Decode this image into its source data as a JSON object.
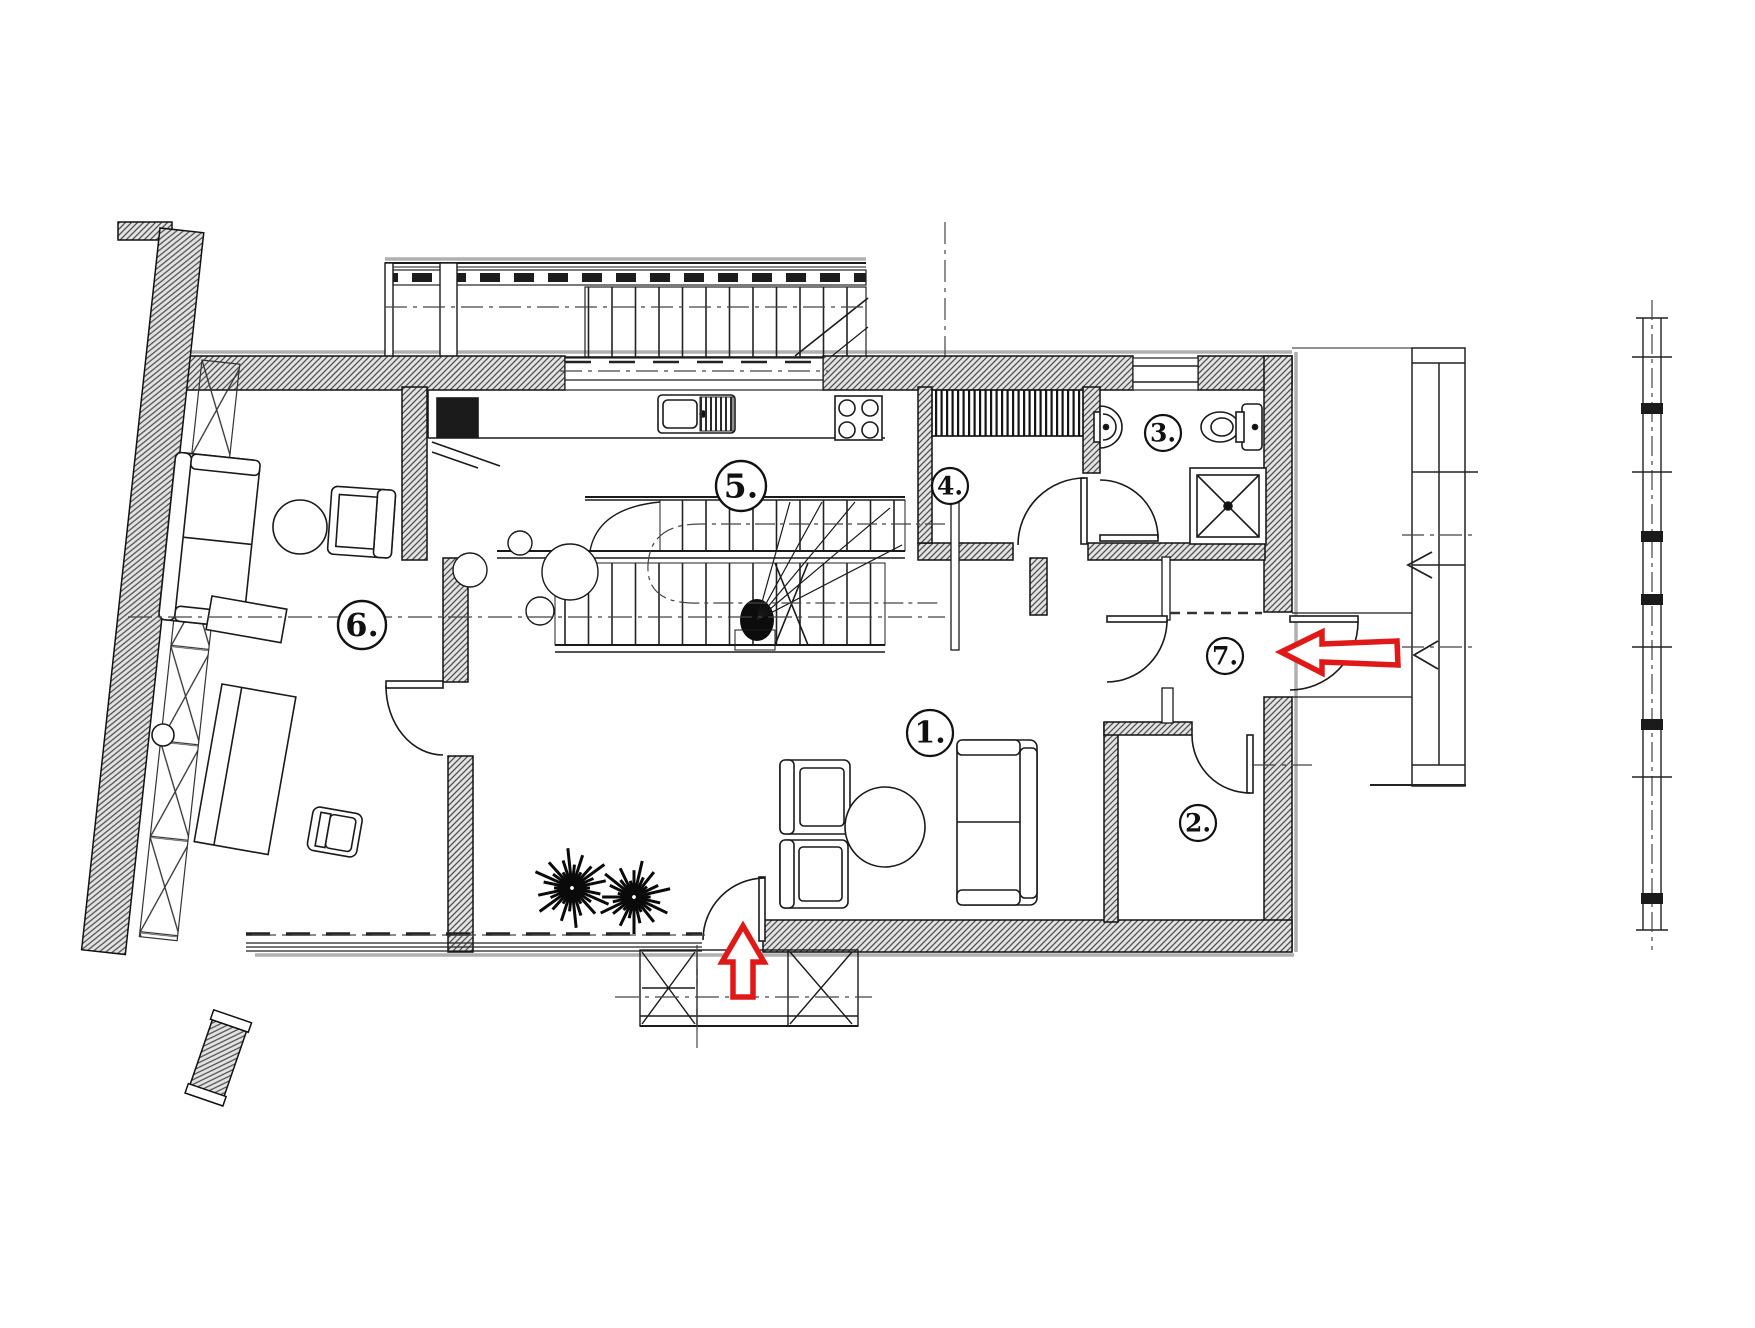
{
  "plan": {
    "rooms": [
      {
        "number": "1."
      },
      {
        "number": "2."
      },
      {
        "number": "3."
      },
      {
        "number": "4."
      },
      {
        "number": "5."
      },
      {
        "number": "6."
      },
      {
        "number": "7."
      }
    ],
    "annotations": {
      "entry_arrow_side": {
        "direction": "left",
        "color": "#e01818"
      },
      "entry_arrow_bottom": {
        "direction": "up",
        "color": "#e01818"
      }
    },
    "colors": {
      "line": "#1a1a1a",
      "wall_hatch": "#4f4f4f",
      "shadow": "#b0b0b0",
      "accent_red": "#e01818"
    },
    "icons": [
      "stairs-icon",
      "kitchen-sink-icon",
      "stove-icon",
      "refrigerator-icon",
      "wardrobe-icon",
      "washbasin-icon",
      "toilet-icon",
      "shower-icon",
      "plant-icon",
      "sofa-icon",
      "armchair-icon",
      "coffee-table-icon",
      "desk-icon",
      "door-swing-icon",
      "balcony-icon",
      "terrace-icon"
    ]
  }
}
